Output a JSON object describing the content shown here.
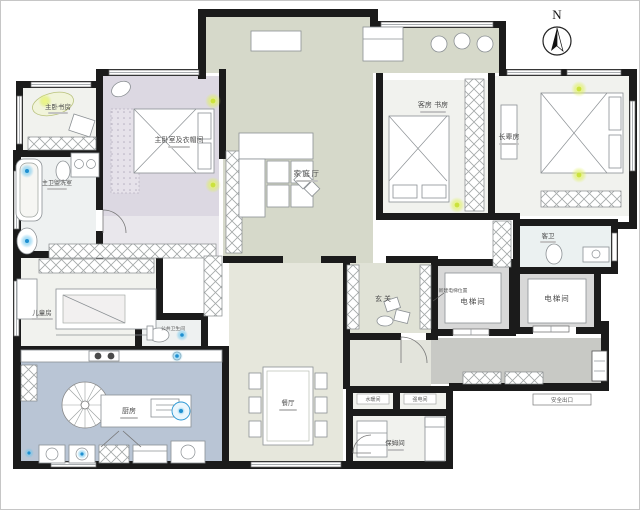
{
  "compass": {
    "label": "N"
  },
  "rooms": {
    "master_study": {
      "label": "主卧书房"
    },
    "master_bedroom": {
      "label": "主卧室及衣帽间"
    },
    "master_bath": {
      "label": "主卫盥洗室"
    },
    "family_hall": {
      "label": "家庭厅"
    },
    "guest_room": {
      "label": "客房 书房"
    },
    "elder_room": {
      "label": "长辈房"
    },
    "guest_bath": {
      "label": "客卫"
    },
    "kids_room": {
      "label": "儿童房"
    },
    "public_bath": {
      "label": "公共卫生间"
    },
    "kitchen": {
      "label": "厨房"
    },
    "dining": {
      "label": "餐厅"
    },
    "foyer": {
      "label": "玄关"
    },
    "elevator_1": {
      "label": "电梯间"
    },
    "elevator_2": {
      "label": "电梯间"
    },
    "plumbing": {
      "label": "水暖间"
    },
    "electrical": {
      "label": "强电间"
    },
    "nanny": {
      "label": "保姆间"
    }
  },
  "annotations": {
    "new_elevator": {
      "label": "新建电梯位置"
    },
    "safety_exit": {
      "label": "安全出口"
    }
  },
  "colors": {
    "wall": "#1b1b1b",
    "family_hall": "#d6d9ca",
    "hall_strip": "#d2d5c6",
    "master_bedroom": "#dcd8e2",
    "closet_corridor": "#e9e7ec",
    "kitchen": "#b9c5d5",
    "dining": "#e6e7dc",
    "foyer": "#e0e2d6",
    "corridor": "#c8c9c5",
    "elevator_shaft": "#d8d8d8",
    "room_light": "#f1f2ee",
    "light_accent": "#d9e84f",
    "water_accent": "#35a8dd"
  }
}
